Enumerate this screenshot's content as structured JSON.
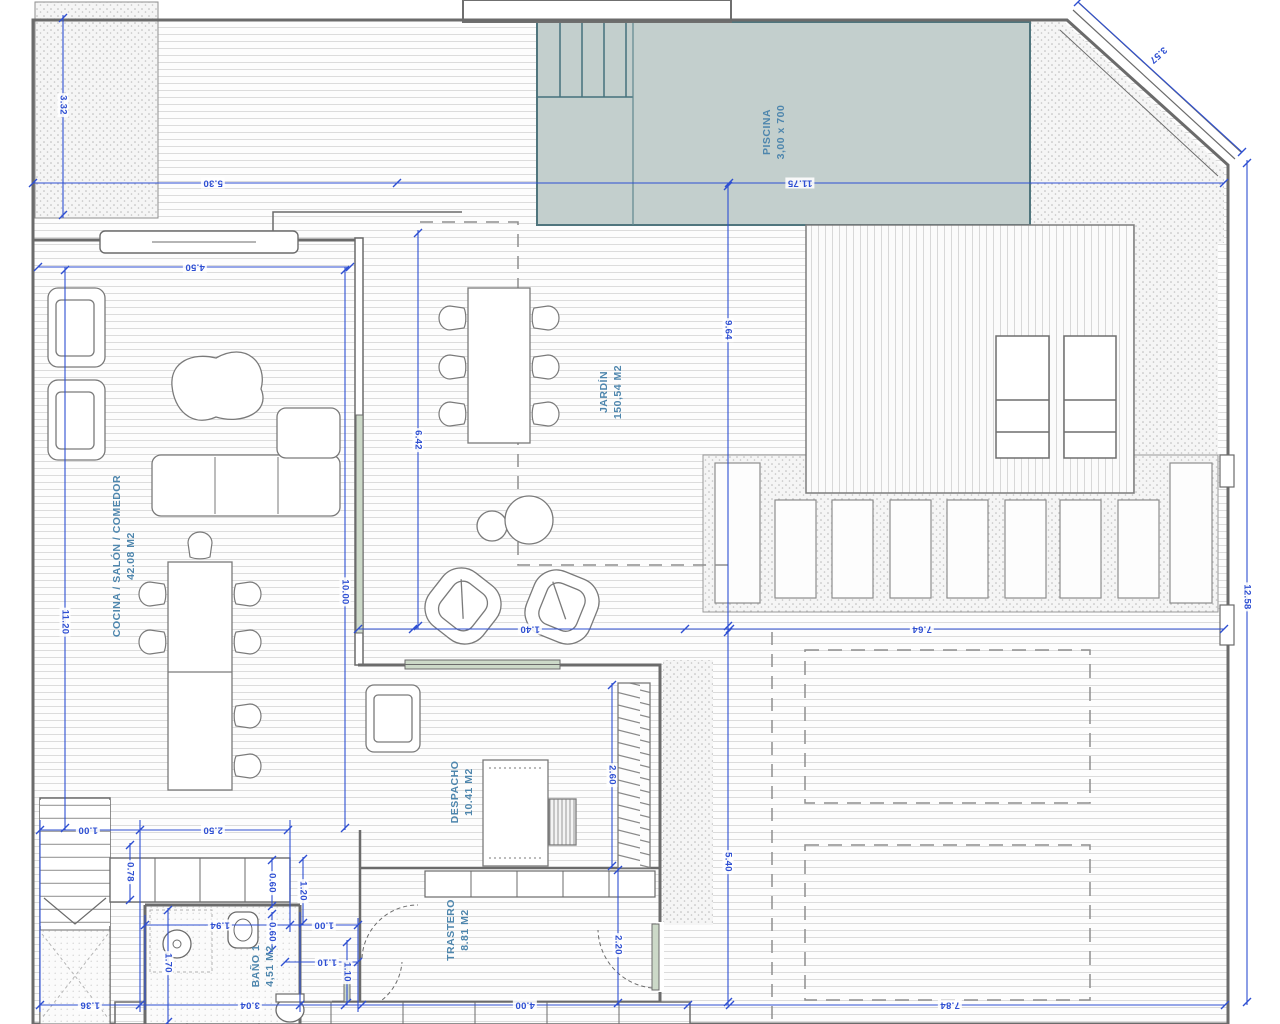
{
  "drawing": {
    "type": "architectural-floor-plan",
    "colors": {
      "dimension_blue": "#2e4fd2",
      "room_label_blue": "#4e86ad",
      "pool_fill": "#c3cfcd",
      "pool_border": "#4f757d",
      "wall_gray": "#6b6b6b",
      "hatch_gray": "#dcdcdc"
    }
  },
  "rooms": {
    "piscina": {
      "name": "PISCINA",
      "detail": "3,00 x 700"
    },
    "jardin": {
      "name": "JARDÍN",
      "detail": "150,54 M2"
    },
    "cocina": {
      "name": "COCINA / SALÓN / COMEDOR",
      "detail": "42.08 M2"
    },
    "despacho": {
      "name": "DESPACHO",
      "detail": "10.41 M2"
    },
    "trastero": {
      "name": "TRASTERO",
      "detail": "8.81 M2"
    },
    "bano": {
      "name": "BAÑO 1",
      "detail": "4,51 M2"
    }
  },
  "dims": {
    "d332": "3.32",
    "d530": "5.30",
    "d1175": "11.75",
    "d357": "3.57",
    "d450": "4.50",
    "d1120": "11.20",
    "d1000": "10.00",
    "d642": "6.42",
    "d964": "9.64",
    "d1258": "12.58",
    "d764": "7.64",
    "d140": "1.40",
    "d250": "2.50",
    "d100a": "1.00",
    "d078": "0.78",
    "d060a": "0.60",
    "d060b": "0.60",
    "d120": "1.20",
    "d194": "1.94",
    "d100b": "1.00",
    "d110a": "1.10",
    "d170": "1.70",
    "d136": "1.36",
    "d304": "3.04",
    "d110b": "1.10",
    "d400": "4.00",
    "d220": "2.20",
    "d260": "2.60",
    "d540": "5.40",
    "d784": "7.84"
  }
}
